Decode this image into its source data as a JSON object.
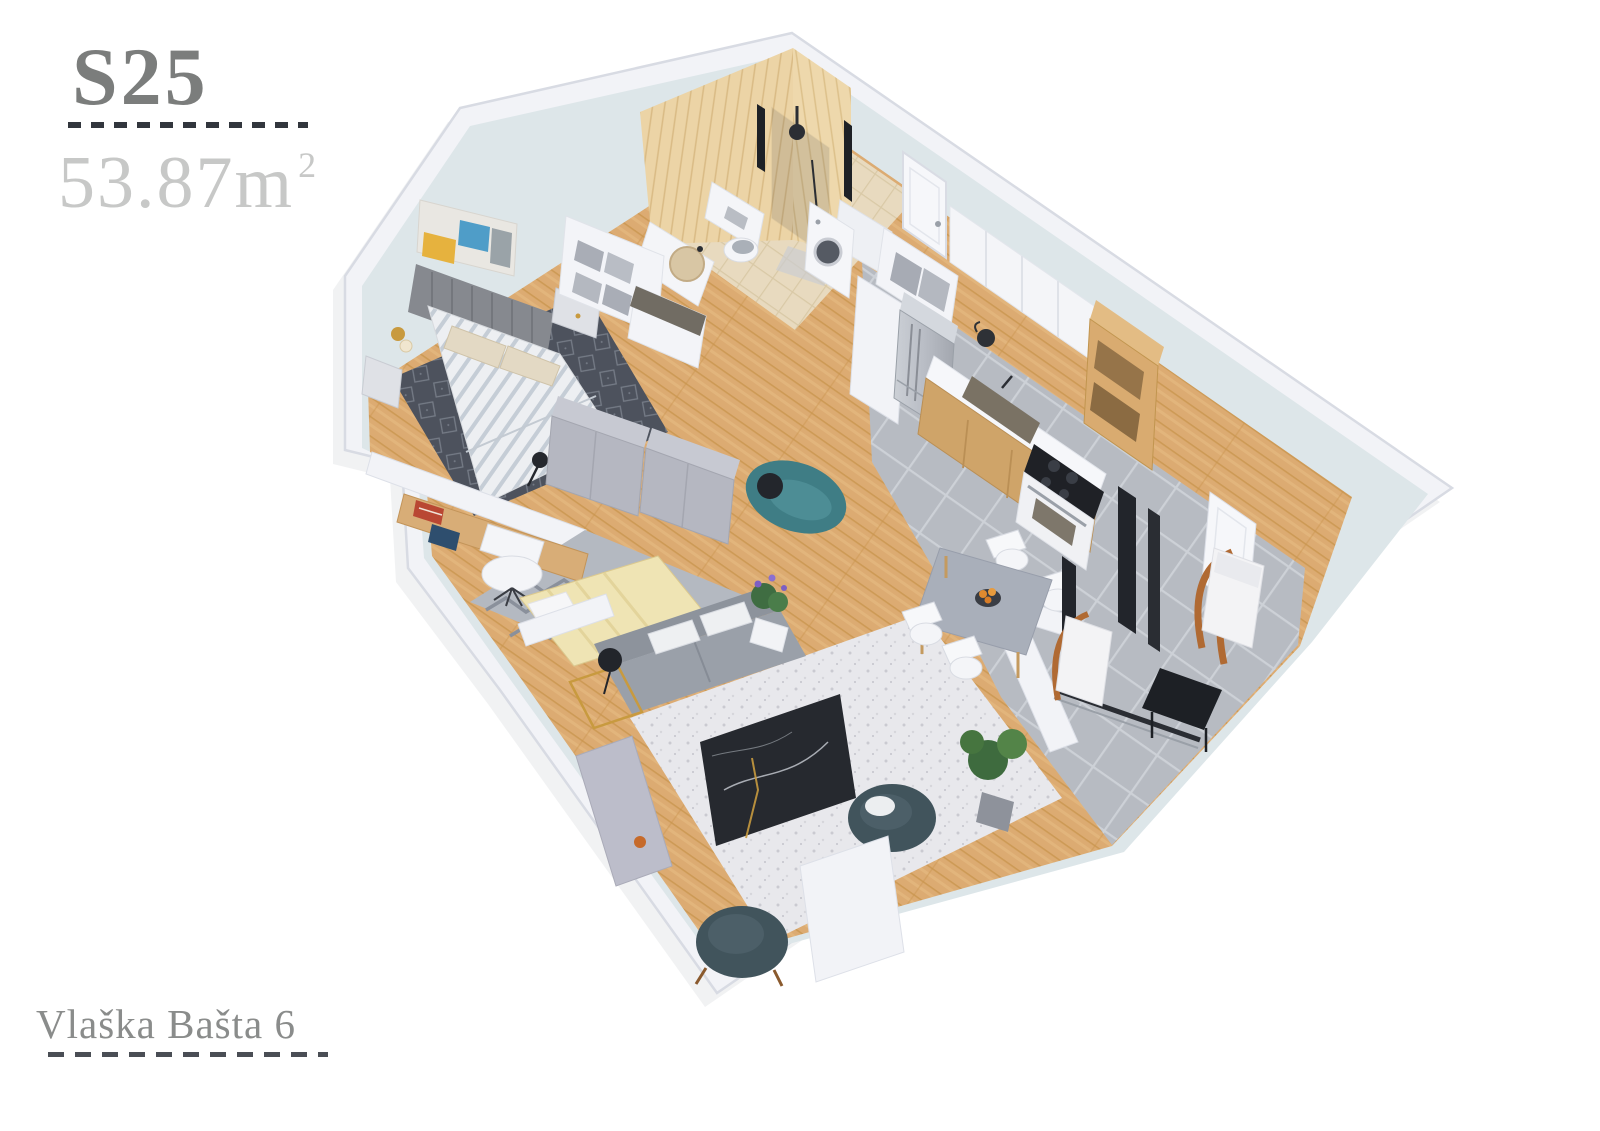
{
  "page": {
    "background_color": "#ffffff"
  },
  "unit_card": {
    "unit_id": "S25",
    "area": {
      "value": "53.87",
      "unit": "m",
      "exponent": "2"
    },
    "address": "Vlaška Bašta 6"
  },
  "palette": {
    "text_dark": "#7b7d7c",
    "text_light": "#c7c8c7",
    "text_address": "#8a8c8b",
    "dash_color": "#32363d",
    "wall_white": "#f2f3f7",
    "wall_face_blue": "#dde6e9",
    "wood_floor": "#dcab72",
    "tile_grey": "#b7bbc2",
    "bath_wall_wood": "#ecd4a6",
    "bath_floor": "#e8dabf",
    "rug_dark": "#4d525d",
    "rug_light": "#e8e8ec",
    "sofa_grey": "#9aa0a9",
    "armchair_teal": "#41545c",
    "settee_teal": "#3f7d85",
    "marble_black": "#26292f",
    "accent_gold": "#c89a3f",
    "lounge_wood_orange": "#b06a33",
    "cabinet_wood": "#cfa469",
    "wardrobe_grey": "#b5b7c1"
  },
  "floorplan": {
    "view": "3d-isometric-render",
    "rooms": [
      {
        "name": "bedroom",
        "furniture": [
          "double-bed",
          "upholstered-headboard",
          "chevron-duvet",
          "pillows",
          "nightstands",
          "wall-sconces",
          "wall-art",
          "storage-cubbies",
          "dark-pattern-rug"
        ]
      },
      {
        "name": "bathroom",
        "furniture": [
          "walk-in-shower",
          "wall-hung-toilet",
          "round-basin-vanity",
          "washing-machine",
          "wood-tile-walls"
        ]
      },
      {
        "name": "study",
        "furniture": [
          "desk",
          "office-chair",
          "desk-lamp",
          "books",
          "wardrobe",
          "daybed",
          "chevron-rug",
          "teal-settee"
        ]
      },
      {
        "name": "kitchen",
        "furniture": [
          "fridge",
          "upper-cabinets",
          "open-shelf-unit",
          "granite-sink-counter",
          "base-cabinets",
          "kettle",
          "cooktop-oven"
        ]
      },
      {
        "name": "dining-area",
        "furniture": [
          "dining-table",
          "four-white-chairs",
          "fruit-bowl"
        ]
      },
      {
        "name": "living-room",
        "furniture": [
          "grey-sofa",
          "gold-side-table",
          "table-lamp",
          "flower-pot",
          "white-area-rug",
          "marble-coffee-table",
          "two-teal-armchairs",
          "sideboard",
          "floor-plant",
          "half-walls"
        ]
      },
      {
        "name": "terrace",
        "furniture": [
          "two-lounge-chairs",
          "black-side-table",
          "sliding-door-frames",
          "terrace-door",
          "grey-tiles"
        ]
      }
    ]
  }
}
